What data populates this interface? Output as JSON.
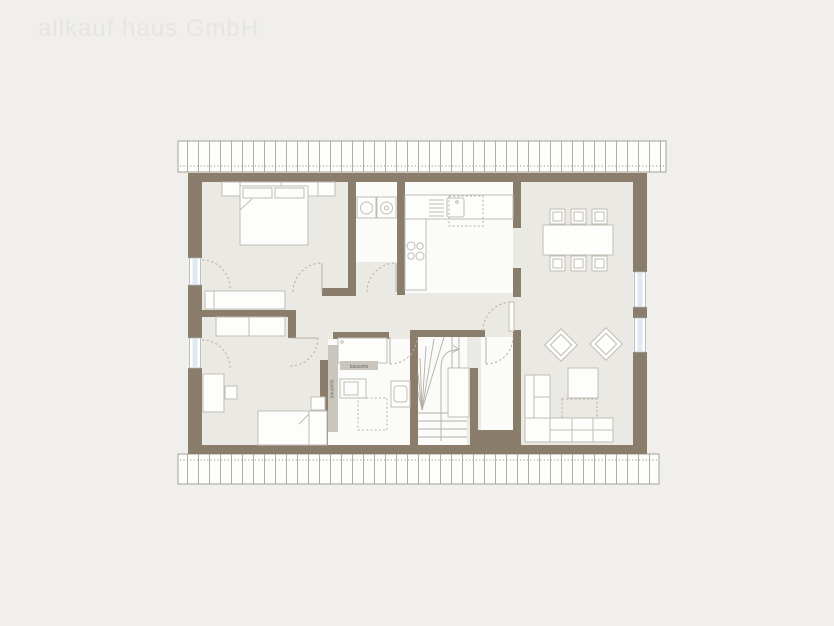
{
  "page": {
    "watermark": "allkauf haus GmbH"
  },
  "labels": {
    "shower_area": "bauseits",
    "wall_strip": "bauseits"
  },
  "palette": {
    "background": "#f0efeb",
    "wall": "#8a7d6c",
    "floor": "#ebe9e4",
    "room_white": "#fbfbf9",
    "furniture_fill": "#fdfdfc",
    "furniture_stroke": "#c1bdb5",
    "line_soft": "#d4d0c8",
    "glass": "#dfe9f2",
    "glass_frame": "#a8b2bc",
    "hatch_line": "#b1ada5",
    "hatch_border": "#a5a199",
    "dotted": "#9b978f",
    "dash": "#b4b0a8",
    "stair_line": "#b3afa7",
    "label_bg": "#cbc6bd",
    "label_text": "#716d65",
    "watermark": "#e6e5e1"
  },
  "icons": [
    "roof-hatch",
    "window",
    "door-swing",
    "double-bed",
    "wardrobe",
    "sideboard",
    "dresser",
    "desk",
    "desk-chair",
    "single-bed",
    "washing-machine",
    "tumble-dryer",
    "kitchen-counter",
    "cooktop",
    "kitchen-sink",
    "dish-drainer",
    "dishwasher-outline",
    "dining-table",
    "dining-chair",
    "armchair",
    "coffee-table",
    "rug-outline",
    "corner-sofa",
    "winder-staircase",
    "stair-landing",
    "walk-line-arrow",
    "shower",
    "washbasin",
    "toilet",
    "bathtub-outline"
  ]
}
